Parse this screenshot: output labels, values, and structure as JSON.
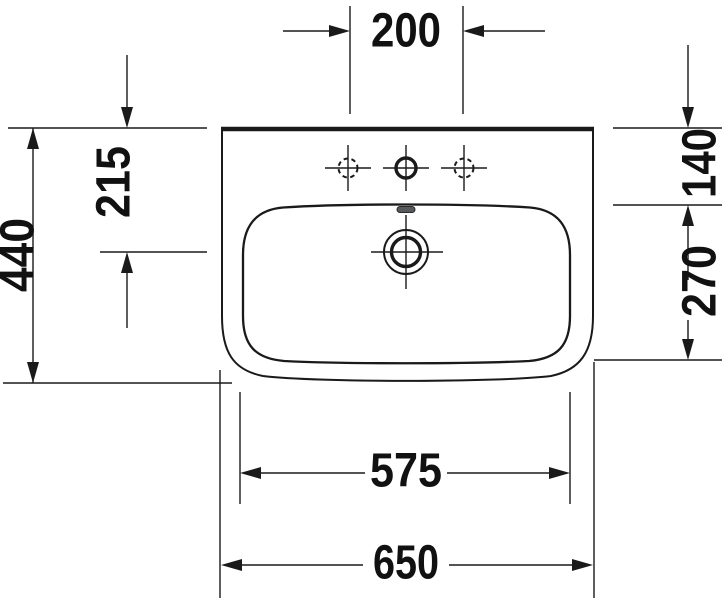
{
  "drawing": {
    "subject": "washbasin-top-view-dimension-drawing",
    "colors": {
      "line": "#1a1a1a",
      "background": "#ffffff",
      "overflow_slot_fill": "#58595b"
    },
    "dimensions": {
      "faucet_hole_spacing": "200",
      "rim_to_drain_center": "215",
      "overall_depth": "440",
      "rim_to_basin_front": "140",
      "basin_depth": "270",
      "basin_inner_width": "575",
      "overall_width": "650"
    },
    "features": {
      "faucet_hole_center": "faucet-hole-solid",
      "faucet_hole_left": "faucet-hole-optional-dashed",
      "faucet_hole_right": "faucet-hole-optional-dashed",
      "drain": "drain-with-crosshair",
      "overflow": "overflow-slot"
    }
  }
}
